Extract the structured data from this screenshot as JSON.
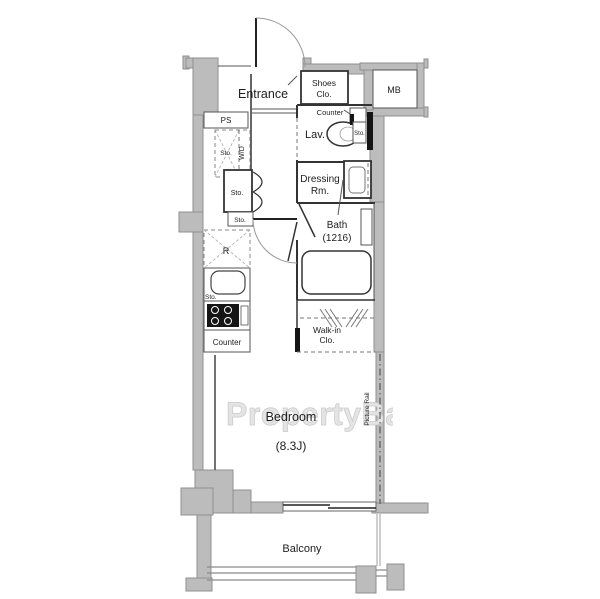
{
  "floorplan": {
    "watermark": "PropertyBank",
    "labels": {
      "entrance": "Entrance",
      "shoes1": "Shoes",
      "shoes2": "Clo.",
      "mb": "MB",
      "counter_entry": "Counter",
      "lav": "Lav.",
      "sto_lav": "Sto.",
      "dressing1": "Dressing",
      "dressing2": "Rm.",
      "bath1": "Bath",
      "bath2": "(1216)",
      "ps": "PS",
      "sto_wd": "Sto.",
      "wd": "W/D",
      "sto_closet": "Sto.",
      "sto_hall": "Sto.",
      "fridge": "R",
      "sto_kitchen": "Sto.",
      "counter_kitchen": "Counter",
      "walkin1": "Walk-in",
      "walkin2": "Clo.",
      "bedroom": "Bedroom",
      "bedroom_size": "(8.3J)",
      "picture_rail": "Picture Rail",
      "balcony": "Balcony"
    },
    "colors": {
      "background": "#ffffff",
      "wall_fill": "#bcbcbc",
      "wall_stroke": "#8f8f8f",
      "line": "#333333",
      "watermark": "#e4e4e4"
    }
  }
}
